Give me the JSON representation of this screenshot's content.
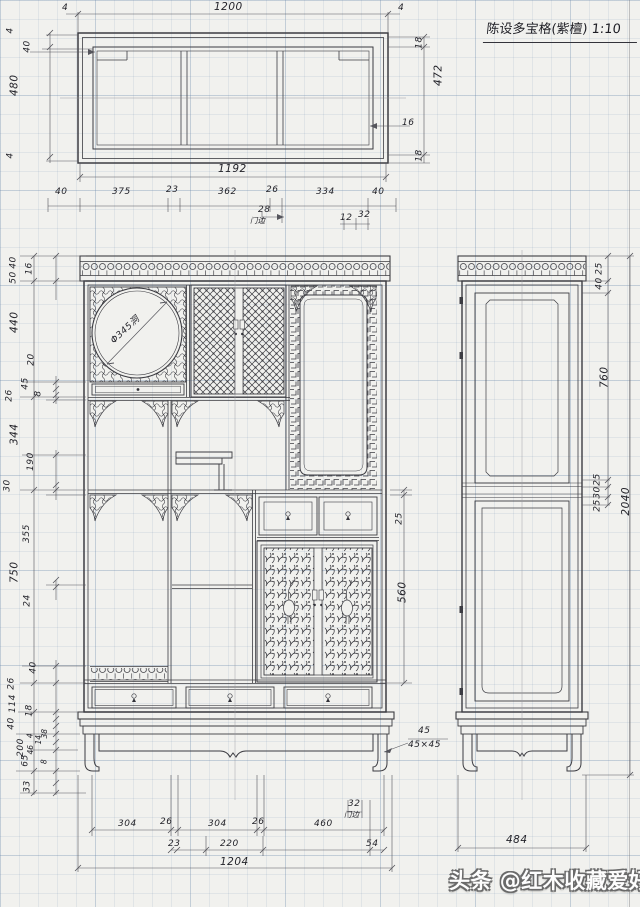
{
  "sheet": {
    "title": "陈设多宝格(紫檀) 1:10",
    "watermark": "头条 @红木收藏爱好者"
  },
  "annotations": {
    "circle_dia": "Φ345洞",
    "leg_callout": "45",
    "leg_section": "45×45",
    "door_edge_note_top": "门边",
    "door_edge_note_bottom": "门边"
  },
  "top_view": {
    "overall_w": "1200",
    "tick_l": "4",
    "tick_r": "4",
    "left": [
      "4",
      "40",
      "480",
      "4"
    ],
    "right": [
      "18",
      "472",
      "16",
      "18"
    ],
    "inner_w": "1192",
    "row": [
      "40",
      "375",
      "23",
      "362",
      "26",
      "334",
      "40"
    ],
    "door_edge_w": "28",
    "sub": [
      "12",
      "32"
    ]
  },
  "front": {
    "left": [
      "40",
      "50",
      "16",
      "440",
      "20",
      "45",
      "8",
      "26",
      "344",
      "190",
      "30",
      "355",
      "750",
      "24",
      "40",
      "26",
      "114",
      "18",
      "40",
      "4",
      "14",
      "38",
      "200",
      "46",
      "65",
      "8",
      "33"
    ],
    "right": [
      "25",
      "560"
    ],
    "bottom_row1": [
      "304",
      "26",
      "304",
      "26",
      "460"
    ],
    "bottom_door_edge": "32",
    "bottom_row2": [
      "23",
      "220",
      "54"
    ],
    "bottom_overall": "1204"
  },
  "side": {
    "top": [
      "25",
      "40"
    ],
    "upper_panel_h": "760",
    "mid": [
      "25",
      "30",
      "25"
    ],
    "overall_h": "2040",
    "depth": "484"
  }
}
